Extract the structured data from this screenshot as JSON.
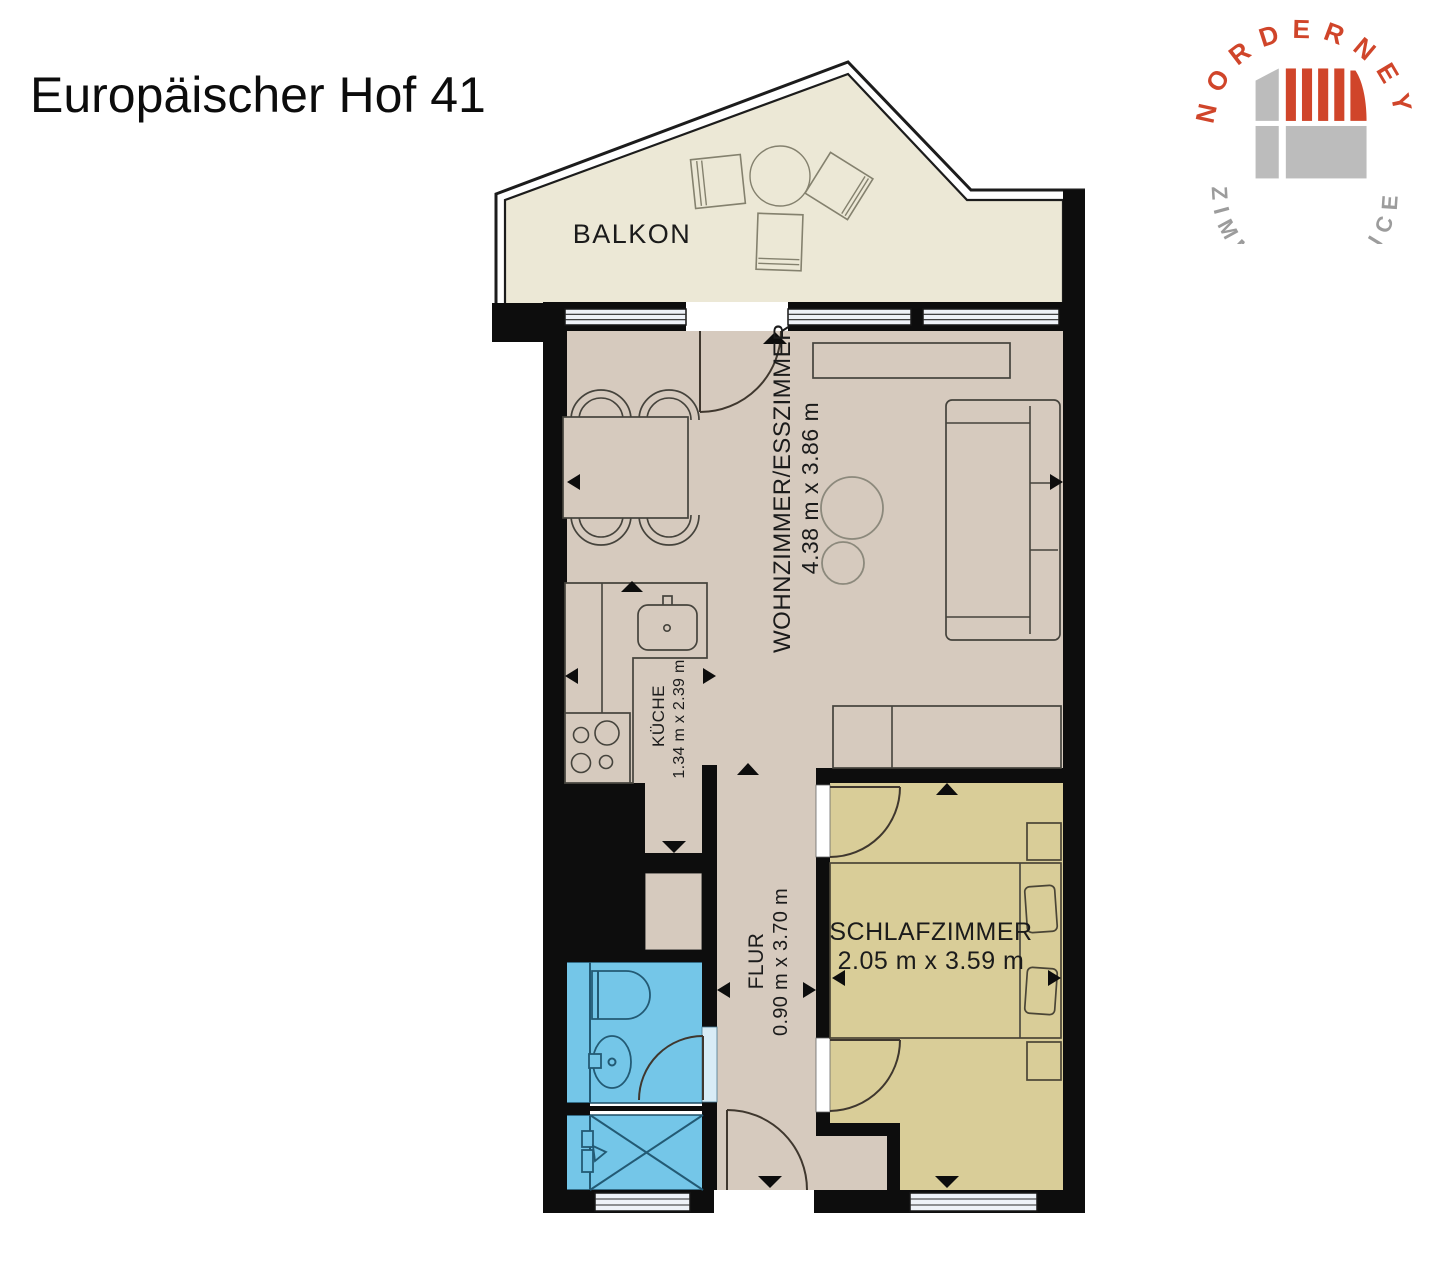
{
  "title": "Europäischer Hof 41",
  "logo": {
    "arc_top": "NORDERNEY",
    "arc_bottom": "ZIMMERSERVICE",
    "red": "#d0452a",
    "gray": "#9c9c9c"
  },
  "rooms": {
    "balkon": {
      "label": "BALKON"
    },
    "wohnzimmer": {
      "label": "WOHNZIMMER/ESSZIMMER",
      "dims": "4.38 m x 3.86 m"
    },
    "kueche": {
      "label": "KÜCHE",
      "dims": "1.34 m x 2.39 m"
    },
    "flur": {
      "label": "FLUR",
      "dims": "0.90 m x 3.70 m"
    },
    "schlafzimmer": {
      "label": "SCHLAFZIMMER",
      "dims": "2.05 m x 3.59 m"
    }
  },
  "colors": {
    "wall": "#0d0d0d",
    "floor_main": "#d6cabe",
    "floor_bedroom": "#d9cd98",
    "floor_bathroom": "#74c6e8",
    "floor_balcony": "#ece8d6",
    "window_glass": "#eef2f8"
  }
}
